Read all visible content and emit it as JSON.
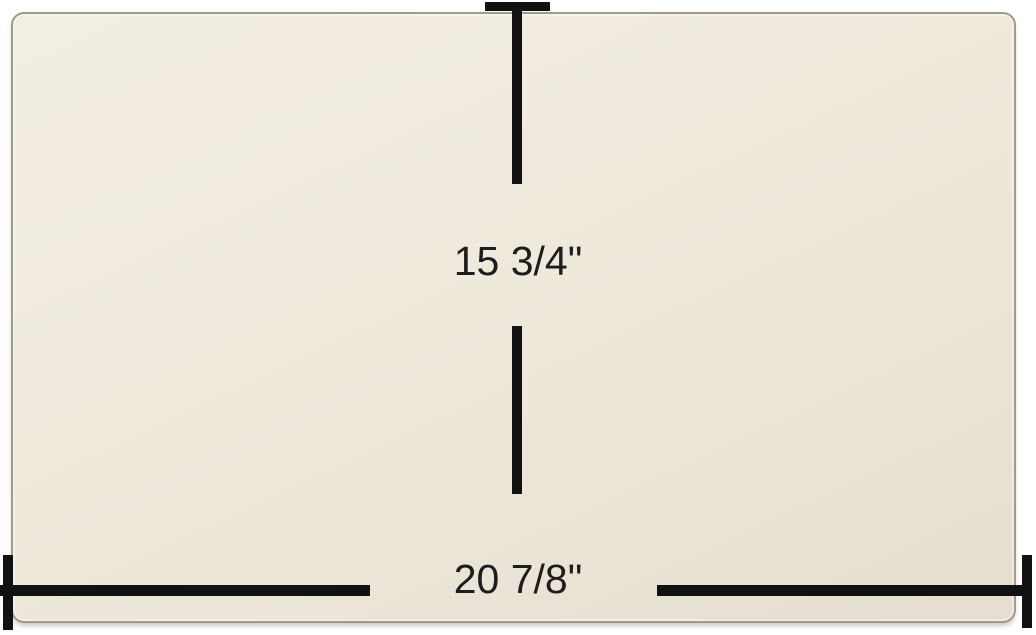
{
  "dimensions": {
    "height_label": "15 3/4\"",
    "width_label": "20 7/8\""
  },
  "colors": {
    "background": "#ffffff",
    "panel_fill": "#efe9dc",
    "panel_fill_light": "#f3eee4",
    "panel_fill_dark": "#e5ded0",
    "panel_edge": "#a29a8c",
    "dimension_line": "#111111",
    "label_text": "#1d1d1d"
  }
}
